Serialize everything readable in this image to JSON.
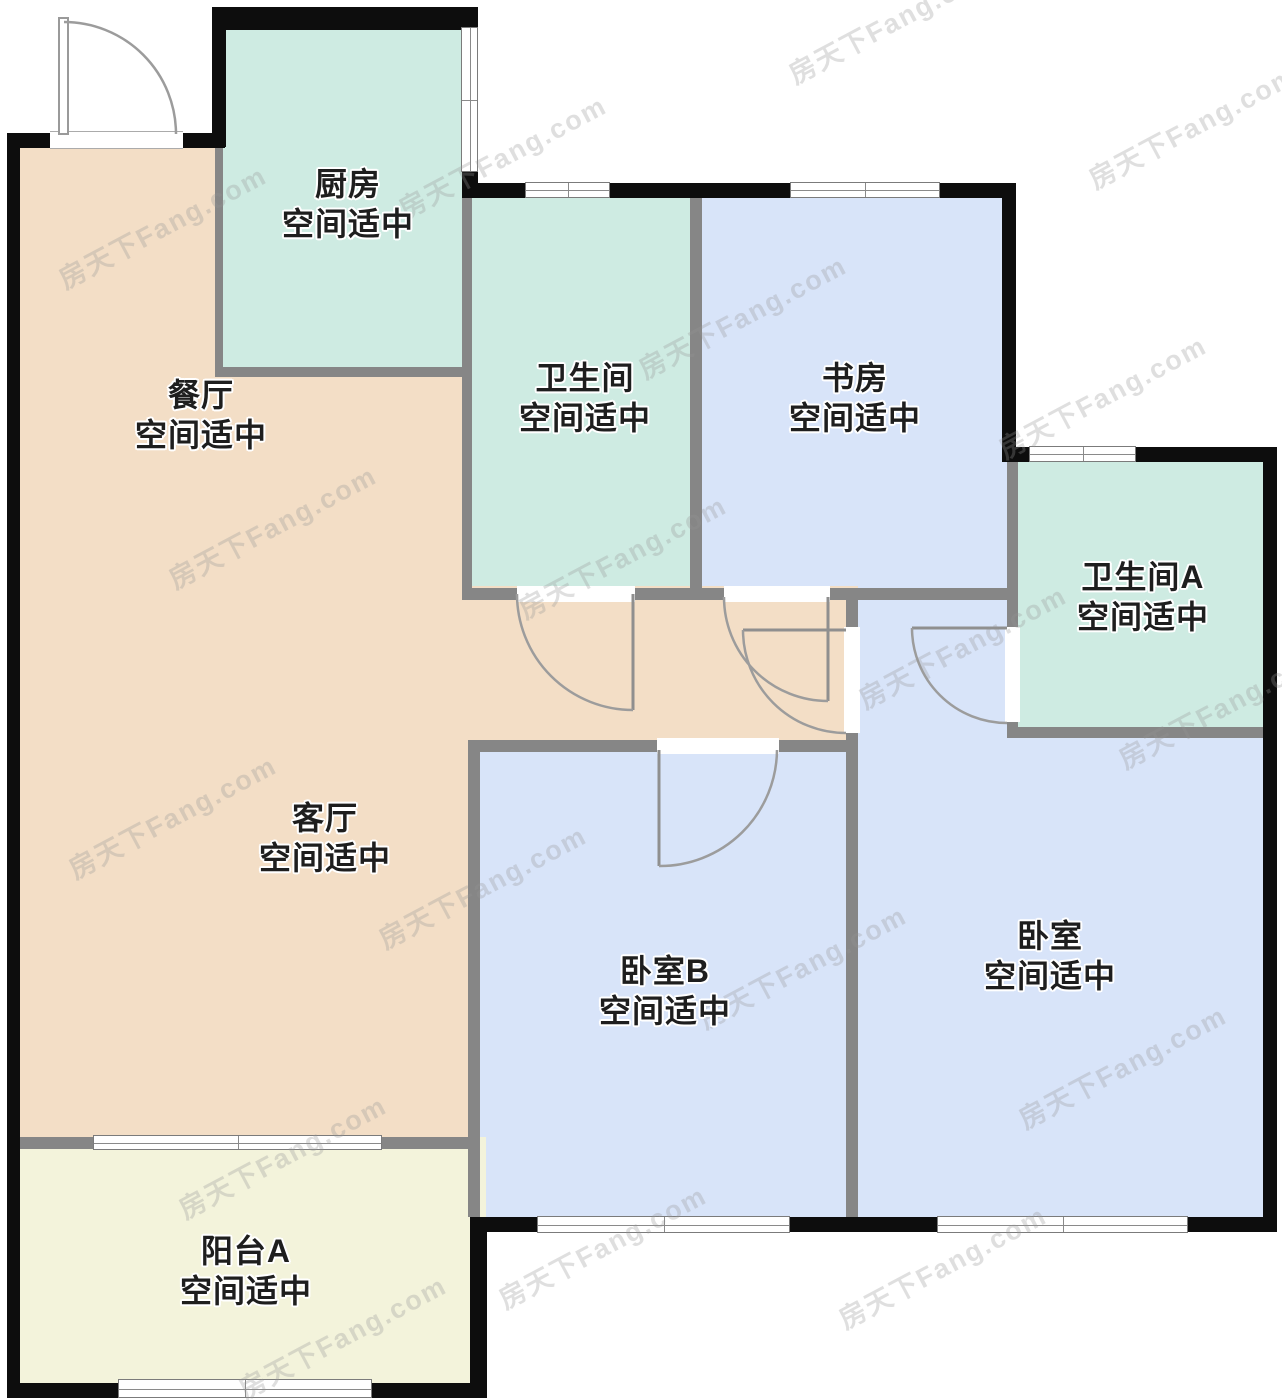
{
  "floorplan": {
    "watermark": "房天下Fang.com",
    "colors": {
      "peach": "#F3DEC6",
      "teal": "#CEEBE2",
      "blue": "#D8E4F9",
      "cream": "#F3F3DB",
      "outer_wall": "#0d0d0d",
      "inner_wall": "#868686",
      "door_line": "#9c9c9c",
      "text": "#1e1e1e"
    },
    "rooms": {
      "kitchen": {
        "name": "厨房",
        "status": "空间适中"
      },
      "dining": {
        "name": "餐厅",
        "status": "空间适中"
      },
      "bathroom": {
        "name": "卫生间",
        "status": "空间适中"
      },
      "study": {
        "name": "书房",
        "status": "空间适中"
      },
      "bathroom_a": {
        "name": "卫生间A",
        "status": "空间适中"
      },
      "living": {
        "name": "客厅",
        "status": "空间适中"
      },
      "bedroom_b": {
        "name": "卧室B",
        "status": "空间适中"
      },
      "bedroom": {
        "name": "卧室",
        "status": "空间适中"
      },
      "balcony": {
        "name": "阳台A",
        "status": "空间适中"
      }
    }
  }
}
